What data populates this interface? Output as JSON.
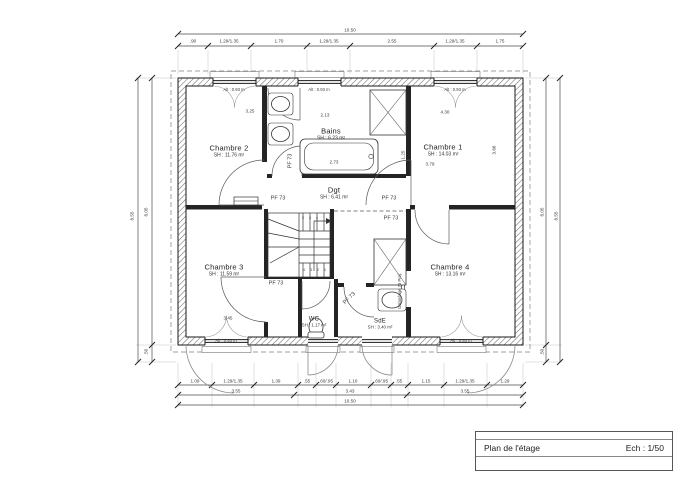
{
  "title_block": {
    "title": "Plan de l'étage",
    "scale": "Ech : 1/50"
  },
  "rooms": [
    {
      "id": "chambre-2",
      "name": "Chambre 2",
      "area": "SH : 11.76 m²"
    },
    {
      "id": "bains",
      "name": "Bains",
      "area": "SH : 6.23 m²"
    },
    {
      "id": "chambre-1",
      "name": "Chambre 1",
      "area": "SH : 14.03 m²"
    },
    {
      "id": "dgt",
      "name": "Dgt",
      "area": "SH : 6.41 m²"
    },
    {
      "id": "chambre-3",
      "name": "Chambre 3",
      "area": "SH : 11.59 m²"
    },
    {
      "id": "chambre-4",
      "name": "Chambre 4",
      "area": "SH : 13.16 m²"
    },
    {
      "id": "sde",
      "name": "SdE",
      "area": "SH : 3.40 m²"
    },
    {
      "id": "wc",
      "name": "WC",
      "area": "SH : 1.17 m²"
    }
  ],
  "annotations": {
    "window_sill_label": "Alt : 0.93 m",
    "door_label": "PF 73",
    "sliding_door_label": "Galandage 73 Proj."
  },
  "dimensions": {
    "top_chain": [
      ".90",
      "1.29/1.35",
      "1.70",
      "1.29/1.35",
      "2.55",
      "1.29/1.35",
      "1.75"
    ],
    "top_total": "10.50",
    "bottom_chain": [
      "1.09",
      "1.29/1.35",
      "1.39",
      ".55",
      ".60/.95",
      "1.10",
      ".60/.95",
      ".55",
      "1.15",
      "1.29/1.35",
      "1.29"
    ],
    "bottom_subtotals": [
      "3.55",
      "3.43",
      "3.55"
    ],
    "bottom_total": "10.50",
    "left_chain": [
      "8.05",
      ".50"
    ],
    "left_total": "8.55",
    "right_chain": [
      "8.05",
      ".50"
    ],
    "right_total": "8.55",
    "interior": [
      "3.25",
      "2.13",
      "4.30",
      "3.79",
      "2.73",
      "3.66",
      "1.25",
      "3.45"
    ]
  },
  "labels": [
    {
      "t": "Alt : 0.93 m",
      "x": 234,
      "y": 90,
      "s": 4.2,
      "n": "window-sill-label"
    },
    {
      "t": "Alt : 0.93 m",
      "x": 319,
      "y": 90,
      "s": 4.2,
      "n": "window-sill-label"
    },
    {
      "t": "Alt : 0.93 m",
      "x": 455,
      "y": 90,
      "s": 4.2,
      "n": "window-sill-label"
    },
    {
      "t": "Alt : 0.93 m",
      "x": 226,
      "y": 341,
      "s": 4.2,
      "n": "window-sill-label"
    },
    {
      "t": "Alt : 0.93 m",
      "x": 461,
      "y": 341,
      "s": 4.2,
      "n": "window-sill-label"
    },
    {
      "t": "PF 73",
      "x": 278,
      "y": 199,
      "s": 5.5,
      "n": "door-label"
    },
    {
      "t": "PF 73",
      "x": 389,
      "y": 199,
      "s": 5.5,
      "n": "door-label"
    },
    {
      "t": "PF 73",
      "x": 391,
      "y": 219,
      "s": 5.5,
      "n": "door-label"
    },
    {
      "t": "PF 73",
      "x": 276,
      "y": 284,
      "s": 5.5,
      "n": "door-label"
    },
    {
      "t": "PF 73",
      "x": 350,
      "y": 299,
      "r": -45,
      "s": 5.5,
      "n": "door-label"
    },
    {
      "t": "PF 73",
      "x": 291,
      "y": 161,
      "r": -90,
      "s": 5.5,
      "n": "door-label"
    },
    {
      "t": "Galandage 73 Proj.",
      "x": 400,
      "y": 291,
      "r": -90,
      "s": 4.2,
      "n": "sliding-door-label"
    },
    {
      "t": ".90",
      "x": 193,
      "y": 42
    },
    {
      "t": "1.29/1.35",
      "x": 229,
      "y": 42
    },
    {
      "t": "1.70",
      "x": 279,
      "y": 42
    },
    {
      "t": "1.29/1.35",
      "x": 329,
      "y": 42
    },
    {
      "t": "2.55",
      "x": 392,
      "y": 42
    },
    {
      "t": "1.29/1.35",
      "x": 455,
      "y": 42
    },
    {
      "t": "1.75",
      "x": 500,
      "y": 42
    },
    {
      "t": "10.50",
      "x": 350,
      "y": 31
    },
    {
      "t": "1.09",
      "x": 195,
      "y": 382
    },
    {
      "t": "1.29/1.35",
      "x": 233,
      "y": 382
    },
    {
      "t": "1.39",
      "x": 276,
      "y": 382
    },
    {
      "t": ".55",
      "x": 307,
      "y": 382
    },
    {
      "t": ".60/.95",
      "x": 326,
      "y": 382
    },
    {
      "t": "1.10",
      "x": 353,
      "y": 382
    },
    {
      "t": ".60/.95",
      "x": 381,
      "y": 382
    },
    {
      "t": ".55",
      "x": 399,
      "y": 382
    },
    {
      "t": "1.15",
      "x": 426,
      "y": 382
    },
    {
      "t": "1.29/1.35",
      "x": 465,
      "y": 382
    },
    {
      "t": "1.29",
      "x": 505,
      "y": 382
    },
    {
      "t": "3.55",
      "x": 236,
      "y": 392
    },
    {
      "t": "3.43",
      "x": 350,
      "y": 392
    },
    {
      "t": "3.55",
      "x": 465,
      "y": 392
    },
    {
      "t": "10.50",
      "x": 350,
      "y": 402
    },
    {
      "t": "8.55",
      "x": 133,
      "y": 216,
      "r": -90
    },
    {
      "t": "8.05",
      "x": 147,
      "y": 212,
      "r": -90
    },
    {
      "t": ".50",
      "x": 147,
      "y": 352,
      "r": -90
    },
    {
      "t": "8.05",
      "x": 543,
      "y": 212,
      "r": -90
    },
    {
      "t": ".50",
      "x": 543,
      "y": 352,
      "r": -90
    },
    {
      "t": "8.55",
      "x": 557,
      "y": 216,
      "r": -90
    },
    {
      "t": "3.25",
      "x": 250,
      "y": 112
    },
    {
      "t": "2.13",
      "x": 325,
      "y": 116
    },
    {
      "t": "4.30",
      "x": 445,
      "y": 113
    },
    {
      "t": "3.79",
      "x": 430,
      "y": 165
    },
    {
      "t": "2.73",
      "x": 334,
      "y": 163
    },
    {
      "t": "3.66",
      "x": 495,
      "y": 150,
      "r": -90
    },
    {
      "t": "1.25",
      "x": 404,
      "y": 155,
      "r": -90
    },
    {
      "t": "3.45",
      "x": 228,
      "y": 319
    },
    {
      "t": "2",
      "x": 303,
      "y": 219,
      "s": 3.6,
      "n": "stair-step-number"
    },
    {
      "t": "3",
      "x": 310,
      "y": 219,
      "s": 3.6,
      "n": "stair-step-number"
    },
    {
      "t": "4",
      "x": 317,
      "y": 219,
      "s": 3.6,
      "n": "stair-step-number"
    },
    {
      "t": "4",
      "x": 304,
      "y": 271,
      "s": 3.6,
      "n": "stair-step-number"
    },
    {
      "t": "3",
      "x": 311,
      "y": 271,
      "s": 3.6,
      "n": "stair-step-number"
    },
    {
      "t": "2",
      "x": 318,
      "y": 271,
      "s": 3.6,
      "n": "stair-step-number"
    },
    {
      "t": "1",
      "x": 325,
      "y": 271,
      "s": 3.6,
      "n": "stair-step-number"
    }
  ]
}
